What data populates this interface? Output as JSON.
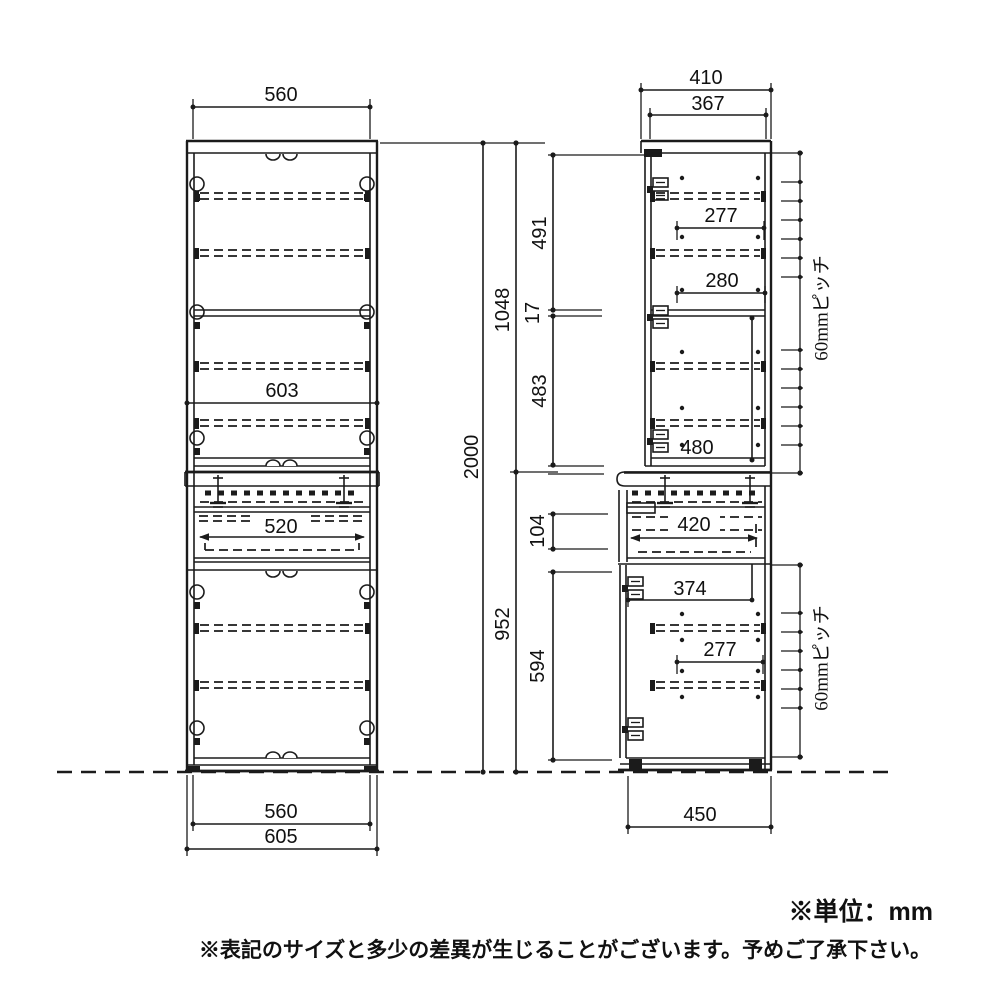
{
  "front_view": {
    "width_top": "560",
    "width_carcass": "603",
    "drawer_width": "520",
    "width_bottom_inner": "560",
    "width_bottom_outer": "605"
  },
  "heights": {
    "total": "2000",
    "upper_unit": "1048",
    "lower_unit": "952",
    "upper_top_section": "491",
    "fixed_shelf_thickness": "17",
    "upper_bottom_section": "483",
    "drawer_front_height": "104",
    "lower_door_height": "594"
  },
  "side_view": {
    "depth_top_outer": "410",
    "depth_top_inner": "367",
    "upper_shelf_depth_1": "277",
    "upper_shelf_depth_2": "280",
    "upper_open_height": "480",
    "drawer_depth": "420",
    "lower_inner_depth": "374",
    "lower_shelf_depth": "277",
    "depth_bottom": "450",
    "shelf_pitch_upper": "60mmピッチ",
    "shelf_pitch_lower": "60mmピッチ"
  },
  "notes": {
    "unit": "※単位：mm",
    "disclaimer": "※表記のサイズと多少の差異が生じることがございます。予めご了承下さい。"
  }
}
